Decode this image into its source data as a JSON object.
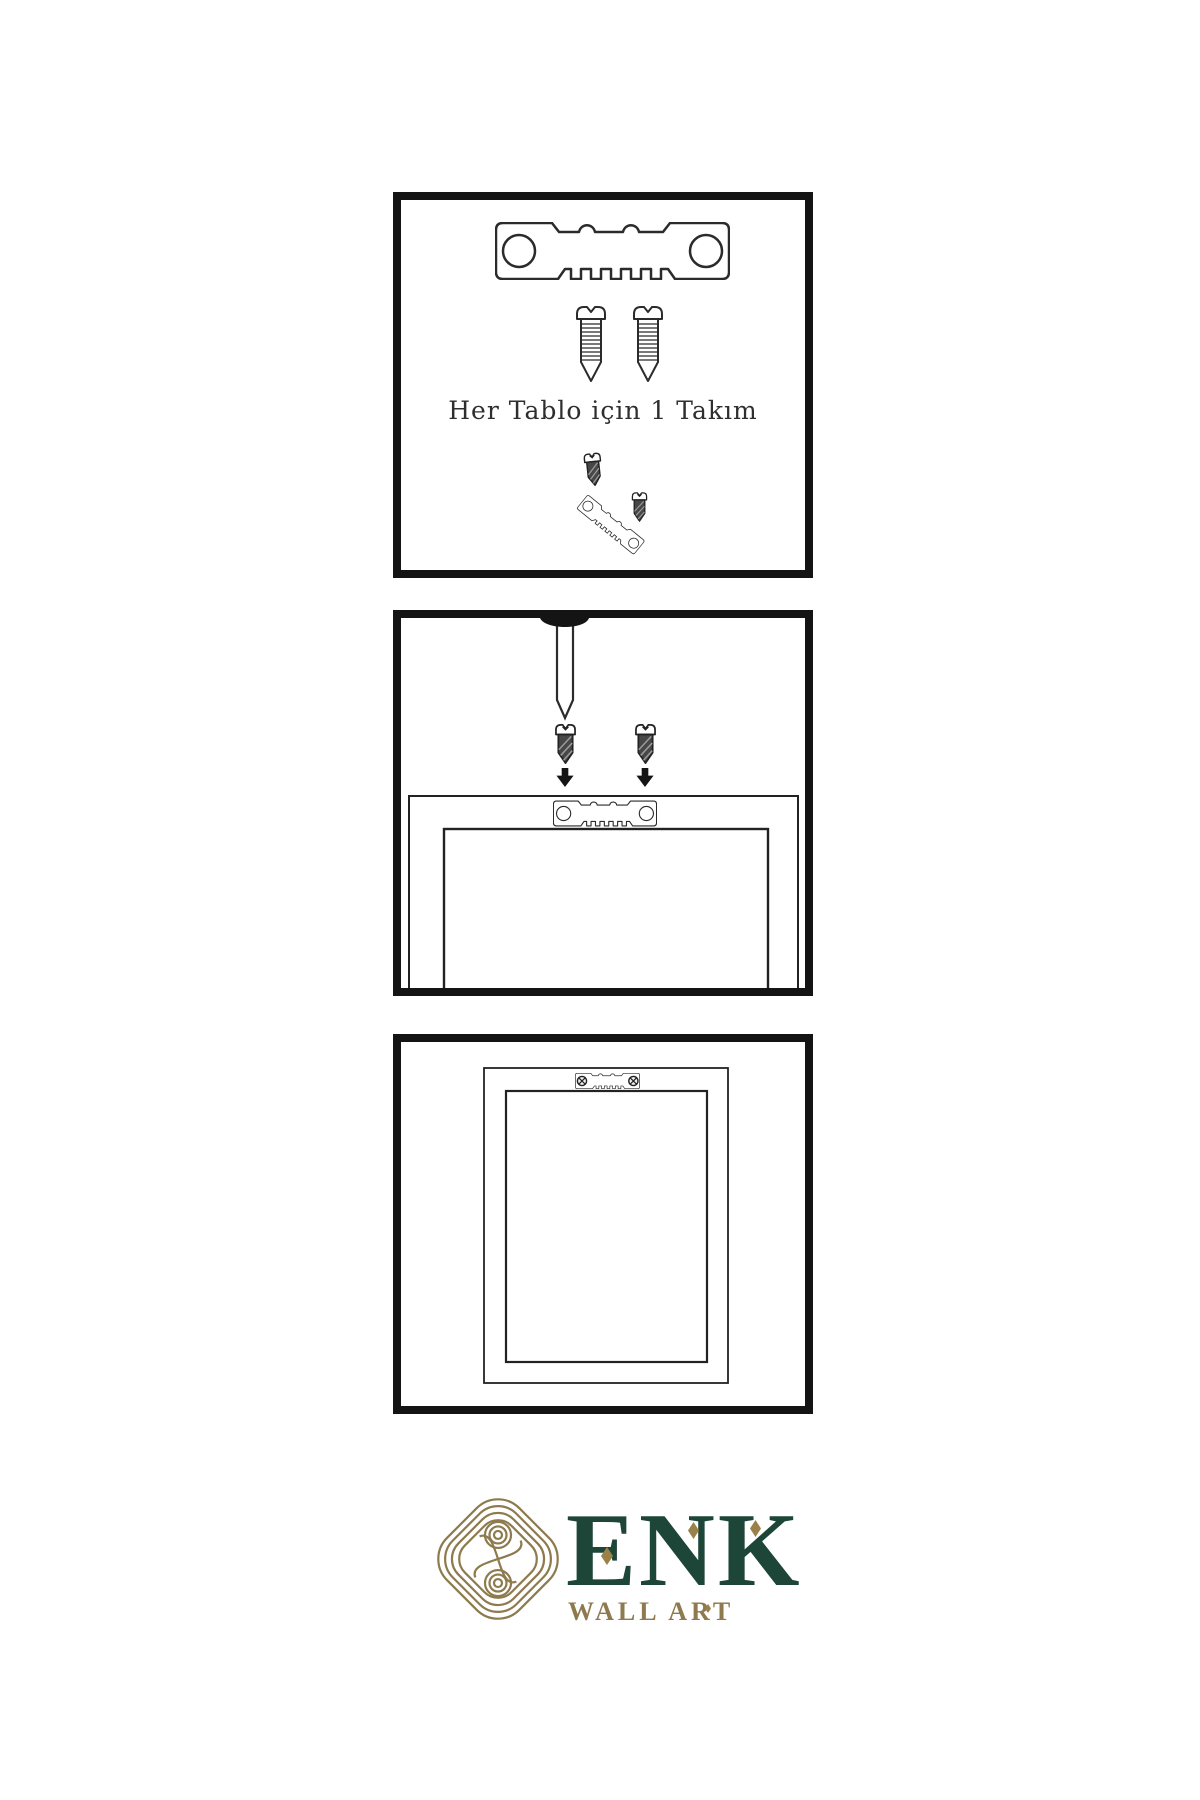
{
  "panels": [
    {
      "name": "panel-hardware-kit",
      "caption": "Her Tablo için 1 Takım",
      "items": [
        "sawtooth-hanger",
        "screw",
        "screw",
        "mounting-screw",
        "angled-sawtooth-hanger",
        "mounting-screw"
      ]
    },
    {
      "name": "panel-mounting-instructions",
      "items": [
        "wall-nail",
        "mounting-screw",
        "mounting-screw",
        "down-arrow",
        "down-arrow",
        "frame-back",
        "sawtooth-hanger"
      ]
    },
    {
      "name": "panel-hanger-installed",
      "items": [
        "frame-back",
        "sawtooth-hanger-with-screws"
      ]
    }
  ],
  "logo": {
    "brand": "ENK",
    "subtitle": "WALL ART",
    "symbol": "interlocked-knot"
  },
  "colors": {
    "background": "#ffffff",
    "panel_border": "#141414",
    "line_ink": "#2b2b2b",
    "screw_dark_fill": "#474747",
    "brand_green": "#1d4538",
    "brand_gold": "#8e7a4e"
  }
}
